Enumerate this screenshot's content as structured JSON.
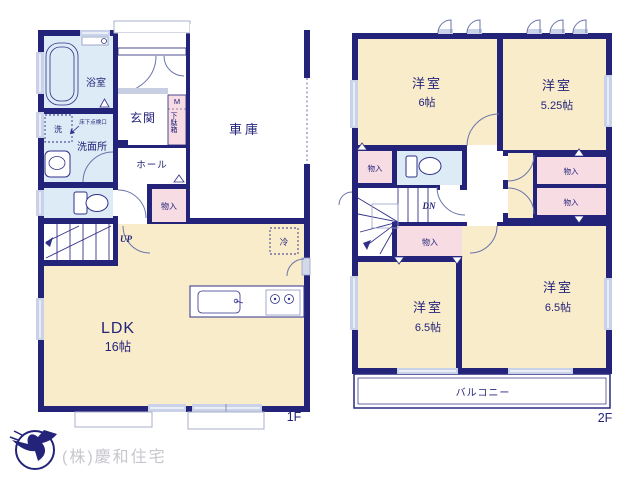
{
  "company": {
    "name": "(株)慶和住宅",
    "logo": "bird-in-circle-icon"
  },
  "f1": {
    "floor": "1F",
    "bath": "浴室",
    "wash": "洗面所",
    "washer": "洗",
    "hatch": "床下点検口",
    "entrance": "玄関",
    "m": "M",
    "shoebox": "下駄箱",
    "hall": "ホール",
    "closet": "物入",
    "garage": "車庫",
    "up": "UP",
    "ldk": "LDK",
    "ldk_size": "16帖",
    "fridge": "冷"
  },
  "f2": {
    "floor": "2F",
    "nw": "洋室",
    "nw_size": "6帖",
    "ne": "洋室",
    "ne_size": "5.25帖",
    "sw": "洋室",
    "sw_size": "6.5帖",
    "se": "洋室",
    "se_size": "6.5帖",
    "closet_left": "物入",
    "closet_right_top": "物入",
    "closet_right_bottom": "物入",
    "closet_south": "物入",
    "dn": "DN",
    "balcony": "バルコニー"
  },
  "colors": {
    "wall": "#23237a",
    "room": "#f8ecca",
    "closet": "#f7dce3",
    "wet": "#dcebf6",
    "window": "#c9d2e8",
    "text": "#23237a",
    "company_text": "#c6c6ce"
  }
}
